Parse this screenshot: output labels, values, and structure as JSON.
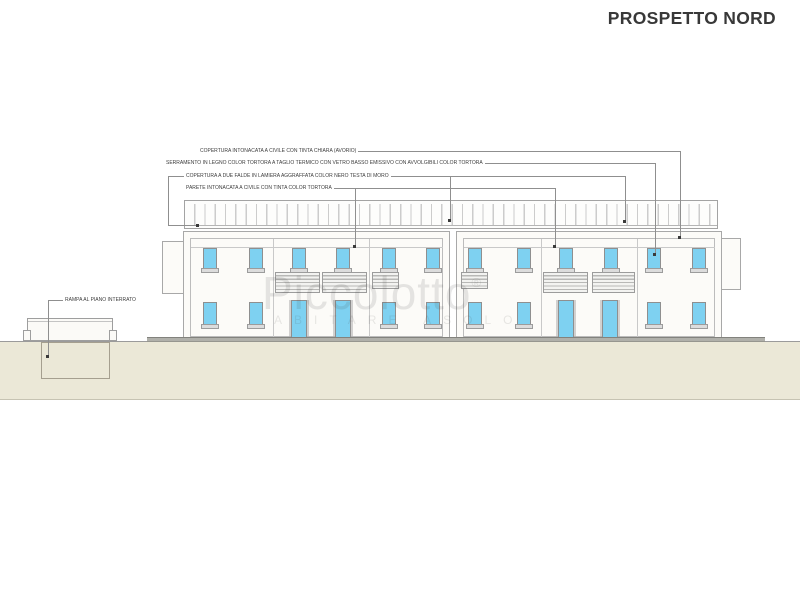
{
  "title": "PROSPETTO NORD",
  "watermark": {
    "brand": "Piccolotto",
    "registered": "®",
    "tagline": "ABITARE ASOLO"
  },
  "annotations": {
    "roof_plaster": "COPERTURA INTONACATA A CIVILE CON TINTA CHIARA (AVORIO)",
    "window_frames": "SERRAMENTO IN LEGNO COLOR TORTORA A TAGLIO TERMICO CON VETRO BASSO EMISSIVO CON AVVOLGIBILI COLOR TORTORA",
    "metal_roof": "COPERTURA A DUE FALDE IN LAMIERA AGGRAFFATA COLOR NERO TESTA DI MORO",
    "wall_plaster": "PARETE INTONACATA A CIVILE CON TINTA COLOR TORTORA",
    "ramp": "RAMPA AL PIANO INTERRATO"
  },
  "colors": {
    "window_glass": "#7ed1f1",
    "terrain": "#ebe8d7",
    "sidewalk": "#b0b0aa",
    "drawing_line": "#9b9b9b",
    "title_text": "#383838"
  },
  "elevation": {
    "windows": [
      {
        "x": 203,
        "y": 248,
        "w": 14,
        "h": 23
      },
      {
        "x": 249,
        "y": 248,
        "w": 14,
        "h": 23
      },
      {
        "x": 292,
        "y": 248,
        "w": 14,
        "h": 23
      },
      {
        "x": 336,
        "y": 248,
        "w": 14,
        "h": 23
      },
      {
        "x": 382,
        "y": 248,
        "w": 14,
        "h": 23
      },
      {
        "x": 426,
        "y": 248,
        "w": 14,
        "h": 23
      },
      {
        "x": 468,
        "y": 248,
        "w": 14,
        "h": 23
      },
      {
        "x": 517,
        "y": 248,
        "w": 14,
        "h": 23
      },
      {
        "x": 559,
        "y": 248,
        "w": 14,
        "h": 23
      },
      {
        "x": 604,
        "y": 248,
        "w": 14,
        "h": 23
      },
      {
        "x": 647,
        "y": 248,
        "w": 14,
        "h": 23
      },
      {
        "x": 692,
        "y": 248,
        "w": 14,
        "h": 23
      },
      {
        "x": 203,
        "y": 302,
        "w": 14,
        "h": 25
      },
      {
        "x": 249,
        "y": 302,
        "w": 14,
        "h": 25
      },
      {
        "x": 382,
        "y": 302,
        "w": 14,
        "h": 25
      },
      {
        "x": 426,
        "y": 302,
        "w": 14,
        "h": 25
      },
      {
        "x": 468,
        "y": 302,
        "w": 14,
        "h": 25
      },
      {
        "x": 517,
        "y": 302,
        "w": 14,
        "h": 25
      },
      {
        "x": 647,
        "y": 302,
        "w": 14,
        "h": 25
      },
      {
        "x": 692,
        "y": 302,
        "w": 14,
        "h": 25
      }
    ],
    "doors": [
      {
        "x": 291,
        "y": 300,
        "w": 16,
        "h": 39
      },
      {
        "x": 335,
        "y": 300,
        "w": 16,
        "h": 39
      },
      {
        "x": 558,
        "y": 300,
        "w": 16,
        "h": 39
      },
      {
        "x": 602,
        "y": 300,
        "w": 16,
        "h": 39
      }
    ],
    "hatches": [
      {
        "x": 275,
        "y": 272,
        "w": 45,
        "h": 21
      },
      {
        "x": 322,
        "y": 272,
        "w": 45,
        "h": 21
      },
      {
        "x": 543,
        "y": 272,
        "w": 45,
        "h": 21
      },
      {
        "x": 592,
        "y": 272,
        "w": 43,
        "h": 21
      },
      {
        "x": 372,
        "y": 272,
        "w": 27,
        "h": 17
      },
      {
        "x": 461,
        "y": 272,
        "w": 27,
        "h": 17
      }
    ],
    "lines": [
      {
        "x": 273,
        "y": 239,
        "w": 1,
        "h": 99
      },
      {
        "x": 369,
        "y": 239,
        "w": 1,
        "h": 99
      },
      {
        "x": 541,
        "y": 239,
        "w": 1,
        "h": 99
      },
      {
        "x": 637,
        "y": 239,
        "w": 1,
        "h": 99
      },
      {
        "x": 191,
        "y": 247,
        "w": 252,
        "h": 1
      },
      {
        "x": 464,
        "y": 247,
        "w": 251,
        "h": 1
      }
    ]
  }
}
